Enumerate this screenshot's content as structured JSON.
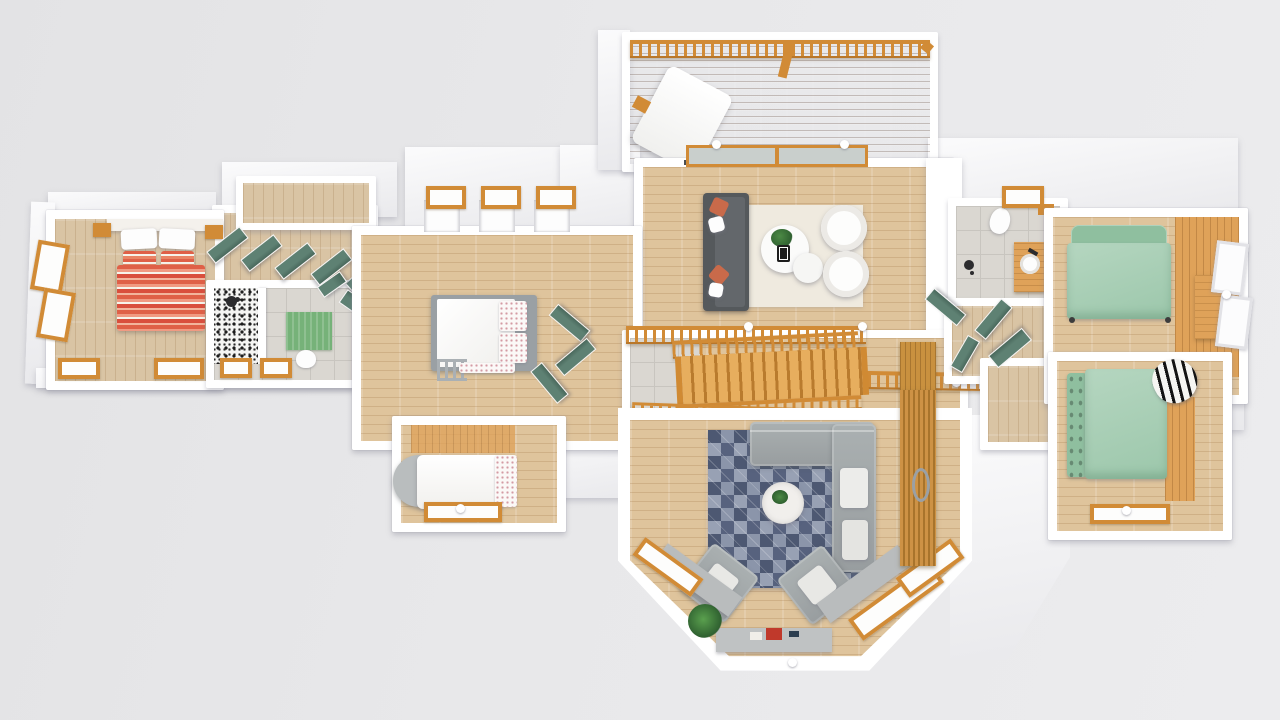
{
  "scene": {
    "title": "3D rendered top-down floor plan of an upper house storey on a gray backdrop",
    "style": "photoreal dollhouse view, no text labels"
  },
  "colors": {
    "wall": "#ffffff",
    "background": "#e7e7e9",
    "floor_wood": "#dfc49c",
    "floor_wood_pale": "#d9c4a4",
    "floor_wood_orange": "#dfa259",
    "railing_wood": "#d18b36",
    "railing_dark": "#b9772a",
    "stair_wood": "#dc9a45",
    "door_green": "#5e8173",
    "door_green_dark": "#49685c",
    "tile_gray": "#dad7d1",
    "tile_line": "#c8c5bf",
    "rug_cream": "#efeadf",
    "rug_blue": "#66708b",
    "sofa_dark": "#55595c",
    "sofa_gray": "#9ba0a2",
    "pillow_orange": "#c96a4a",
    "bed_mint": "#a9cfb5",
    "bed_mint_dark": "#8fbf9f",
    "mat_green": "#76b279",
    "marble": "#f1efec",
    "plant_green": "#3f7d3a",
    "deck_wood": "#b79e8d",
    "glass": "#c9cfcc",
    "metal_gray": "#9aa0a4"
  },
  "rooms": [
    {
      "name": "deck",
      "floor": "weathered-deck-planks",
      "features": [
        "baluster-railing",
        "lounge-chair"
      ]
    },
    {
      "name": "living-room",
      "floor": "light-wood",
      "furniture": [
        "dark-gray-sofa",
        "orange-pillows",
        "cream-rug",
        "round-coffee-tables",
        "plant",
        "two-round-armchairs",
        "sliding-glass-doors"
      ]
    },
    {
      "name": "master-bedroom",
      "floor": "light-wood",
      "furniture": [
        "double-bed-orange-striped",
        "white-pillows",
        "nightstands"
      ],
      "windows": 4
    },
    {
      "name": "bathroom-left",
      "floor": "gray-tile",
      "fixtures": [
        "mosaic-shower",
        "toilet",
        "green-bath-mat"
      ],
      "windows": 2
    },
    {
      "name": "hallway-left",
      "floor": "light-wood",
      "features": [
        "open-green-doors",
        "walk-in-closet"
      ]
    },
    {
      "name": "bedroom-middle",
      "floor": "light-wood",
      "furniture": [
        "bunk-bed-white",
        "ladder",
        "floral-pillows"
      ],
      "features": [
        "three-dormer-windows"
      ]
    },
    {
      "name": "bedroom-nook",
      "floor": "light-wood",
      "furniture": [
        "single-bed-round-headboard",
        "floral-pillow"
      ],
      "windows": 1
    },
    {
      "name": "stair-hall",
      "features": [
        "wood-staircase",
        "balustrades",
        "tile-landing",
        "walkway"
      ]
    },
    {
      "name": "family-room",
      "floor": "light-wood",
      "furniture": [
        "gray-sectional",
        "two-gray-armchairs",
        "blue-triangle-rug",
        "round-marble-table",
        "window-bench",
        "potted-plant"
      ],
      "features": [
        "bay-window",
        "wood-slat-barn-door"
      ]
    },
    {
      "name": "bathroom-right",
      "floor": "gray-tile",
      "fixtures": [
        "toilet",
        "wood-vanity-round-sink",
        "shower"
      ],
      "windows": 1
    },
    {
      "name": "bedroom-right-top",
      "floor": "light-wood",
      "furniture": [
        "double-bed-mint",
        "wood-desk"
      ],
      "windows": 2
    },
    {
      "name": "bedroom-right-bottom",
      "floor": "light-wood",
      "furniture": [
        "double-bed-mint-tufted-headboard",
        "zebra-pillow"
      ],
      "windows": 1
    }
  ]
}
